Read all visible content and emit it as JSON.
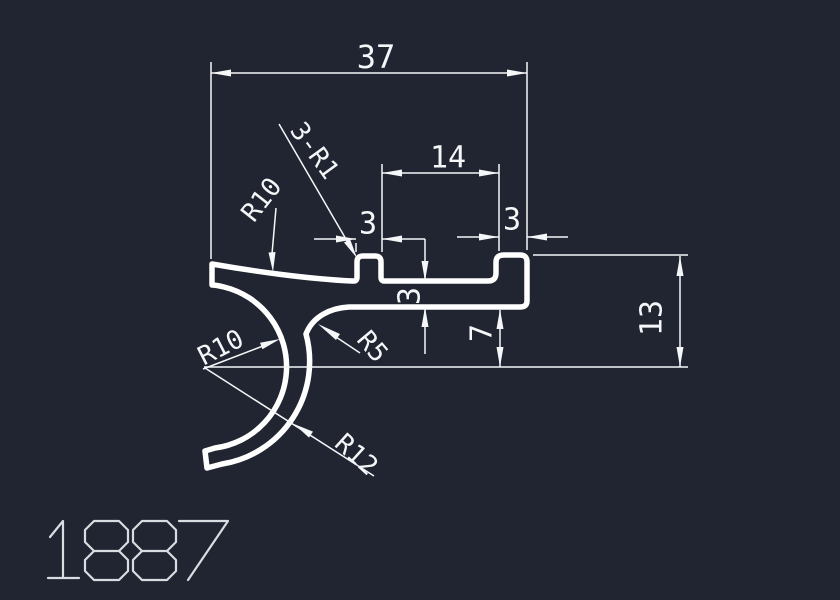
{
  "canvas": {
    "background": "#212531",
    "line_color": "#f4f6f8",
    "profile_color": "#ffffff",
    "part_number_color": "#d9dde2"
  },
  "part": {
    "number": "1887"
  },
  "dimensions": {
    "total_width": "37",
    "inner_width": "14",
    "slot_width": "3",
    "step_width": "3",
    "web_thickness": "3",
    "web_drop": "7",
    "end_height": "13"
  },
  "radius_labels": {
    "top_radius": "R10",
    "corner_note": "3-R1",
    "hook_radius": "R10",
    "fillet_radius": "R5",
    "hook_outer_radius": "R12"
  }
}
